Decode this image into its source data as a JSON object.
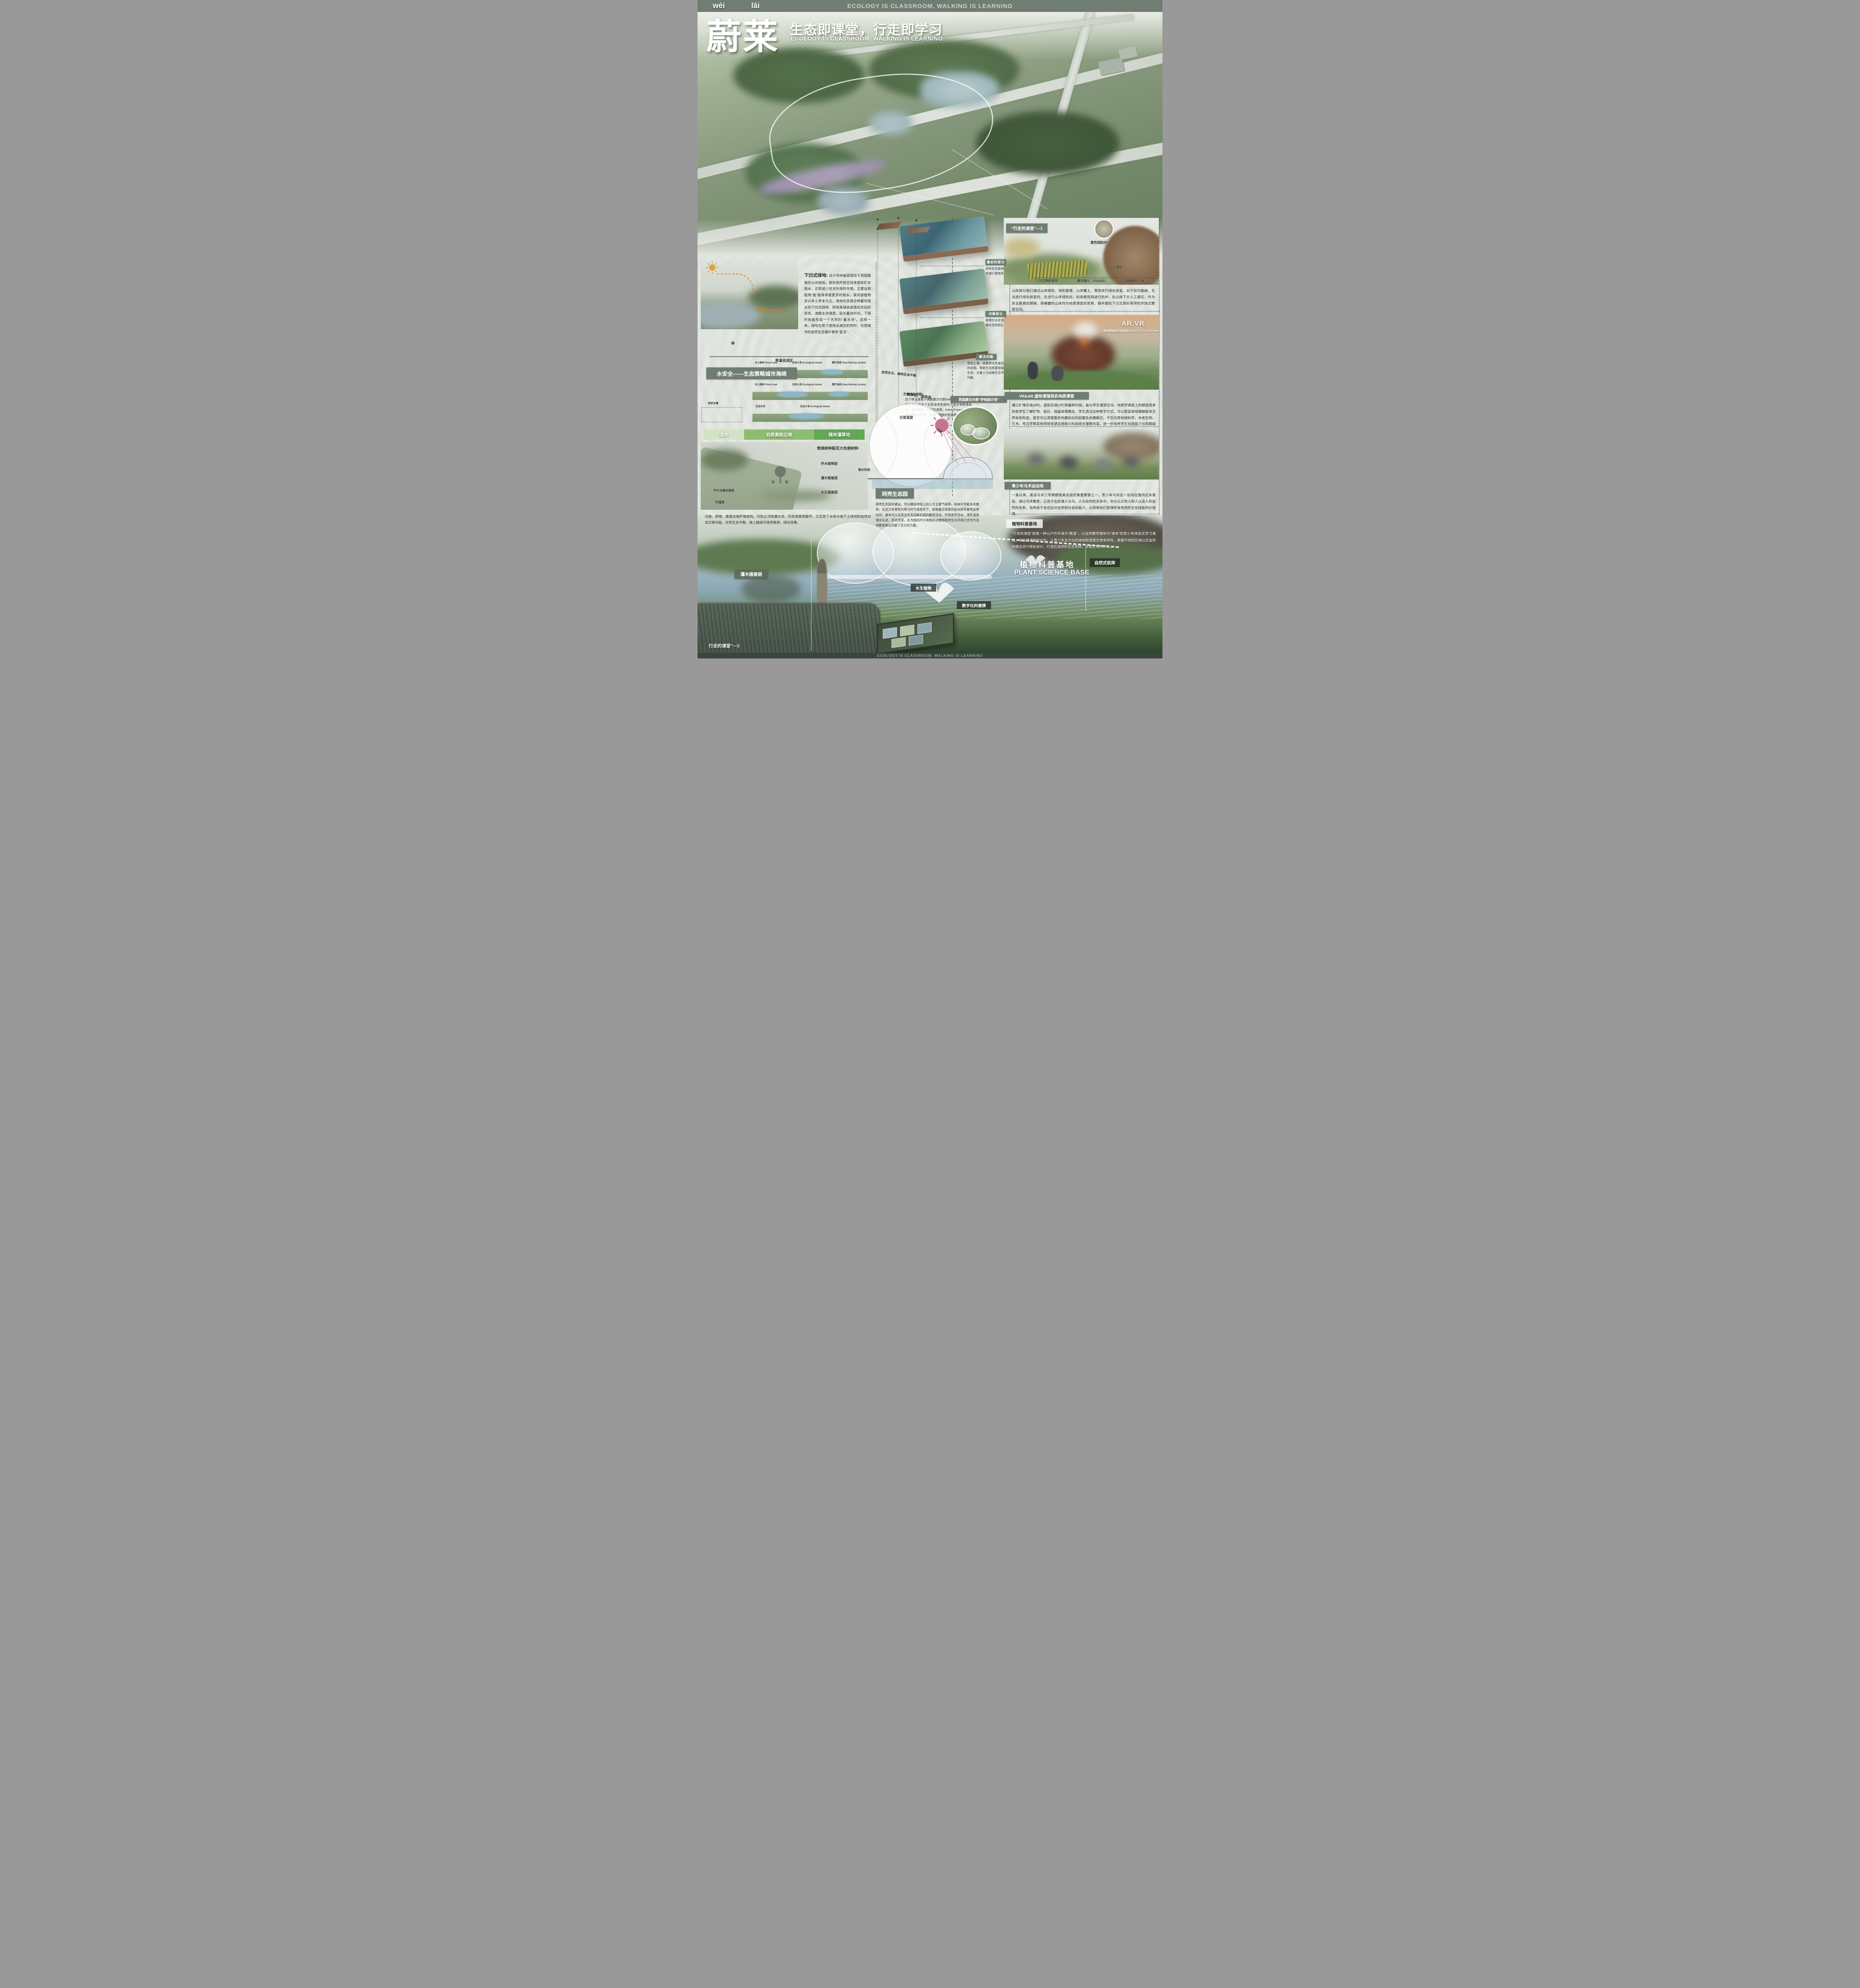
{
  "banner": {
    "top": "ECOLOGY IS CLASSROOM, WALKING IS LEARNING",
    "bottom": "ECOLOGY IS CLASSROOM, WALKING IS LEARNING"
  },
  "header": {
    "pinyin_wei": "wèi",
    "pinyin_lai": "lāi",
    "title_cn": "蔚莱",
    "slogan_cn": "生态即课堂，行走即学习",
    "slogan_en": "ECOLOGY IS CLASSROOM, WALKING IS LEARNING"
  },
  "left": {
    "sunken_title": "下凹式绿地:",
    "sunken_body": "设计场地被高程低于周围路面的公共绿地，是利用开放空间承接和贮存雨水，达到减少径流外排的作用。主要运用植物“面”能够承接更多的雨水，其内部植物多以本土草本为主。场地内多建这种蓄存雨水的下凹式绿地，把地表铺装成类似农田的状态，减缓水流速度，延长蓄存时间，下雨时就能形成一个天然的“蓄水池”。这样一来，绿地在帮下游排水减压的同时，也使城市的自然生态循环重新“复活”。",
    "evaporation": "蒸发 Evaporation",
    "dry_creek": "旱溪径流区",
    "detention": "滞",
    "pond_label": "现状水塘",
    "water_title": "水安全——生态策略城市海绵",
    "section_labels": [
      "水上森林 Flood road",
      "生态小岛 Ecological Island",
      "慢行系统 Slow Moving System",
      "生态水泡"
    ],
    "green_bars": [
      "湿地",
      "岩质高陡边坡",
      "疏林灌草地"
    ],
    "plants": {
      "evergreen": "常绿树种配花大色艳树种",
      "arbor": "乔木植物层",
      "shrub": "灌木植被层",
      "aquatic": "水生植被层",
      "mix": "乔灌草",
      "vine": "乔木及藤本植物"
    },
    "bottom_para": "河道、岸坡、路基边坡护坡结构。可防止河岸遭水流、风浪侵袭而破坏，又实现了水体与坡下土体间的自然对流交换功能，达到生态平衡。坡上植绿可增添景观、绿化效果。"
  },
  "middle": {
    "stages": [
      {
        "label": "最初的部分",
        "body": "采砂砍伐森林树木减少湿地退化"
      },
      {
        "label": "问题部分",
        "body": "填埋坑水在地上展示自然岩石"
      },
      {
        "label": "解决问题",
        "body": "增加土壤，收集雨水形成自然的水网。帮助生态修复和植被生长。注重人与动物生态平衡问题。"
      }
    ],
    "notes": [
      "石头，沙子",
      "土地净化，湿地泡",
      "自然生长，维持生态平衡"
    ],
    "dome": {
      "quote_title": "“网壳生态园”",
      "quote_body": "这个想法是鉴于英国康沃尔郡Eden Project，伊甸园计划，由多个巨型温室构成的人造生物群落系统。是全球第一个球形温室。Eden Project一直以来都是绿色环保、科研、教育的坚定拥护者。",
      "eden_label": "英国康沃尔郡“伊甸园计划”",
      "greenhouse": "巨型温室",
      "sun": "光照",
      "rain": "雨水利用"
    },
    "netshell": {
      "title": "网壳生态园",
      "body": "网壳生态园的建设，可以模拟地球上的三大主要气候带，收纳尽可能多的植物，在武汉冬季较为寒冷的气候条件下，能够最大程度的延长研学基地运营时间，基本可以实现全年无间断的园内教育活动、环保宣传活动，球形温室理念先进、形式活泼，在为园内不计其数的动植物提供生存环境之余也为自然教育事业贡献了巨大的力量。"
    }
  },
  "right": {
    "w1": {
      "tag": "“行走的课堂”—1",
      "net": "柔性网防护",
      "rock": "人工塑石",
      "cap": [
        "下沉式草阶草坪",
        "教学展示（VR&AR）",
        "较陡峭的山体"
      ],
      "body": "山体部分我们通过山体排险、地形整理、山体覆土，再而进行绿化修复，对于较为陡峭，无法进行绿化修复的，在进行山体排险后，利用柔性网进行防护，在山体下方人工塑石，作为安全距离的屏障，将裸露的山体作为地质课堂的背景，做半圆形下沉式草阶草坪的开放式教育空间。"
    },
    "ar": {
      "overlay": "AR.VR",
      "overlay_sub": "虚拟增强现实地质课堂 REALITY CLASSROOM",
      "label": "VR&AR 虚拟增强现实地质课堂",
      "body": "通过扩增实境(AR)、虚拟实境(VR)等最新科技，能与学生增添互动，地质学课堂上的模型用来协助学生了解矿物、岩石、结晶体等概念，学生透过这种数字方式，可以更容易地理解板块交界处和构造，甚至可以清楚看到地震前后的前震及余震模式。不仅仅是地球科学，未来生物、艺术、考古学等其他领域有望运用新兴科技结合课程内容，进一步培养学生创造能力与观察能力。"
    },
    "eq": {
      "label": "青少年马术运动场",
      "body": "一直以来，奥运马术三项赛都是奥运会的重要赛事之一，青少年马术这一运动在国内还未普及。通过马术教育，让孩子在处理人与马、人与自然的关系中，充分认识到人和人以及人和自然的关系，培养孩子自信应对自然和社会的能力，从而使他们获得终身受用的生存技能和价值观。"
    },
    "pb": {
      "label": "植物科普基地",
      "body": "“行走的课堂”就是一种以户外环境为“教室”，以自然教学媒体为“课本”的青少年体验式学习课程。将自然课搬到户外，让青少年全方位的体验和感受生物多样性，根据不同的区域以近自然的理念进行规划设计，打造近自然的生态系统，丰富生物多样性。"
    }
  },
  "bottom": {
    "shrub": "灌木植被层",
    "aquatic": "水生植物",
    "sign": "数字化科普牌",
    "base_cn": "植物科普基地",
    "base_en": "PLANT SCIENCE BASE",
    "bank": "自然式驳岸",
    "walking2": "行走的课堂”—2"
  },
  "colors": {
    "banner_bg": "#6f7d72",
    "banner_bottom_bg": "#39453d",
    "label_green": "#6f7d72",
    "bar_light": "#d3e2c4",
    "bar_mid": "#8cbd70",
    "bar_dark": "#62a855",
    "sun_pink": "#c4748c"
  }
}
